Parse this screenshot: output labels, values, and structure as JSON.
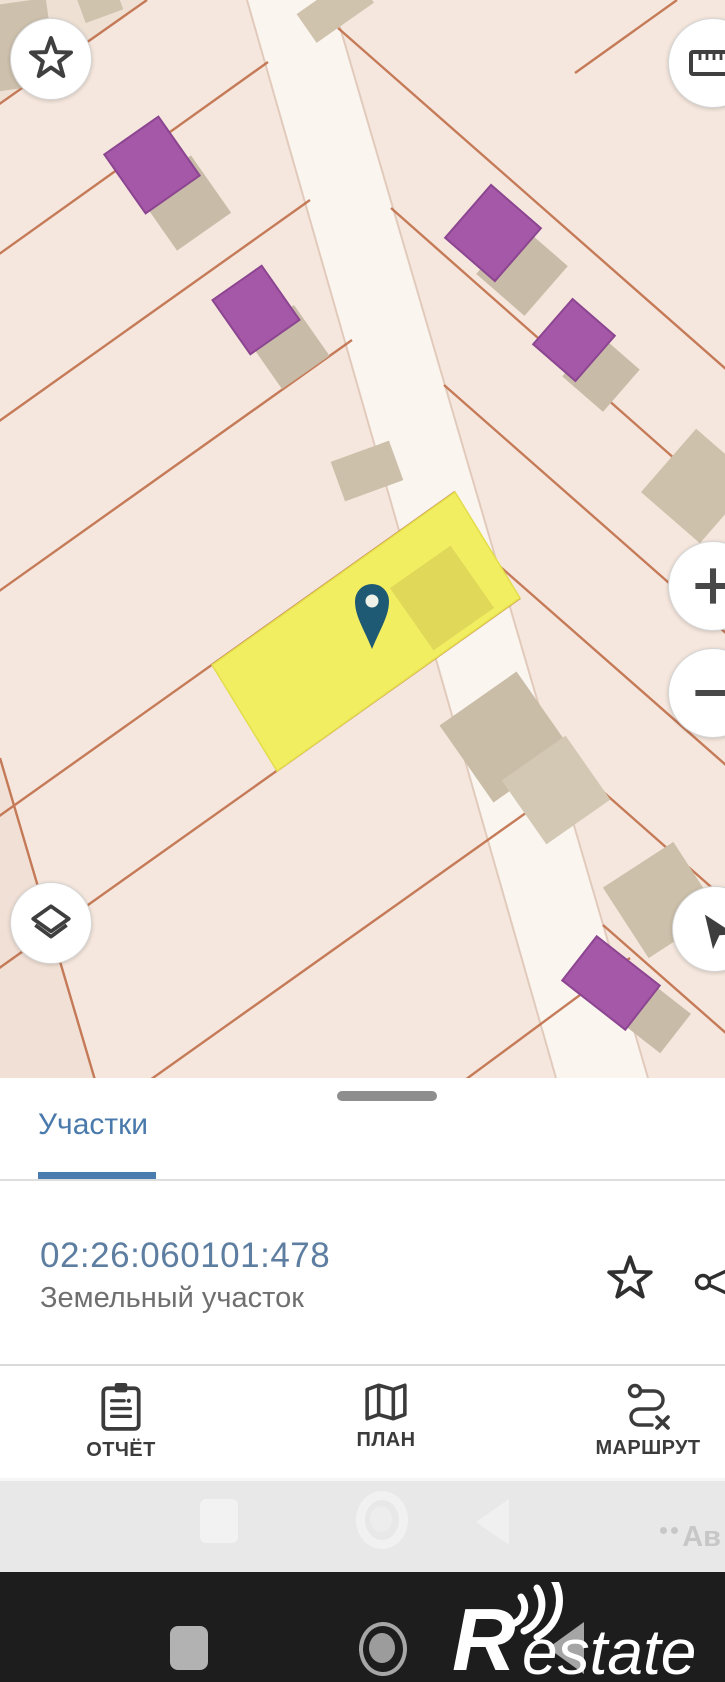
{
  "map": {
    "controls": {
      "favorites_icon": "star-icon",
      "measure_icon": "ruler-icon",
      "zoom_in_icon": "plus-icon",
      "zoom_out_icon": "minus-icon",
      "layers_icon": "layers-icon",
      "locate_icon": "navigation-arrow-icon"
    },
    "selected_parcel_highlight": "#f2ee62",
    "pin_color": "#1f5a74",
    "map_background": "#f5e7dd",
    "parcel_line_color": "#c06f4a",
    "building_color": "#a558a7"
  },
  "sheet": {
    "tab_label": "Участки",
    "tab_accent_color": "#4a7aac",
    "parcel_number": "02:26:060101:478",
    "parcel_number_color": "#5d7ea0",
    "parcel_type": "Земельный участок",
    "row_icons": [
      "star-outline-icon",
      "share-icon"
    ],
    "actions": [
      {
        "label": "ОТЧЁТ",
        "icon": "clipboard-icon"
      },
      {
        "label": "ПЛАН",
        "icon": "folded-map-icon"
      },
      {
        "label": "МАРШРУТ",
        "icon": "route-icon"
      }
    ]
  },
  "navbar": {
    "ghost_watermark": "Ав",
    "buttons": [
      "recents",
      "home",
      "back"
    ]
  },
  "watermark": {
    "brand_initial": "R",
    "brand_rest": "estate"
  }
}
